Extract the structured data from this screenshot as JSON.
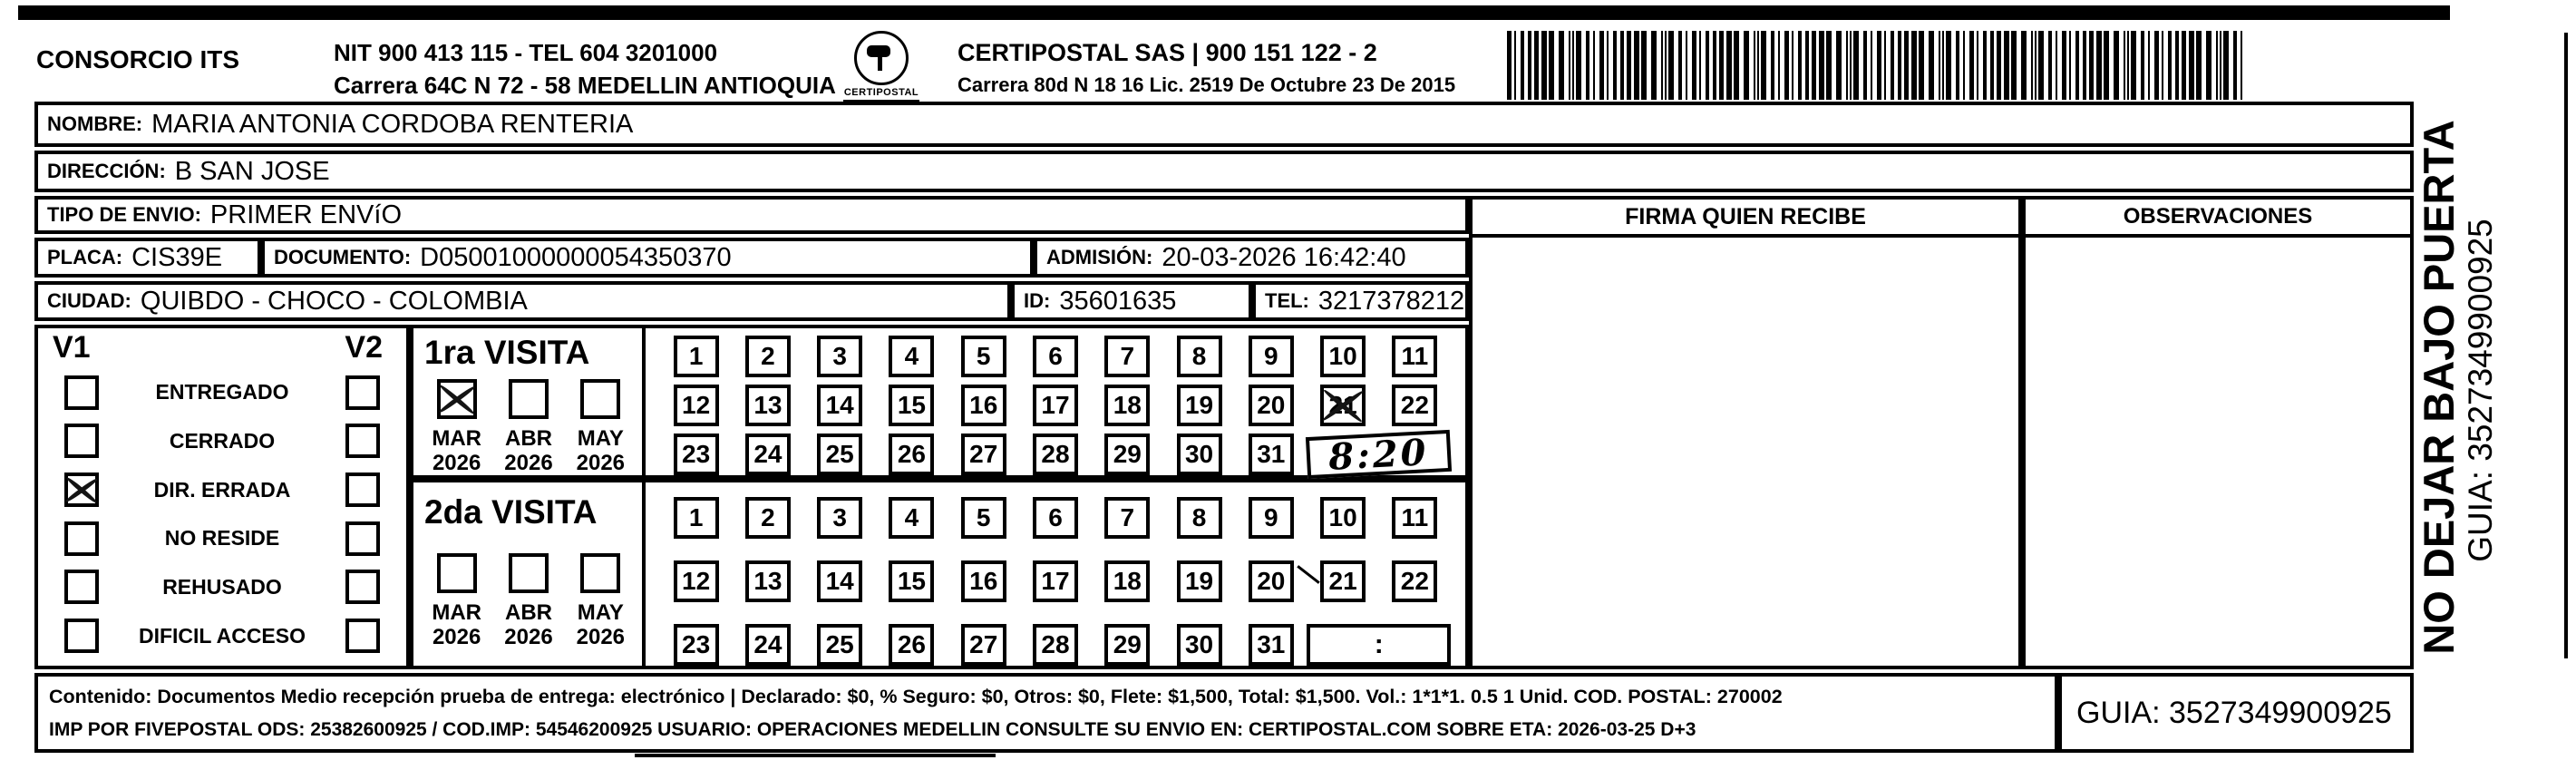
{
  "header": {
    "company": "CONSORCIO ITS",
    "nit_line1": "NIT 900 413 115 - TEL 604 3201000",
    "nit_line2": "Carrera 64C N 72 - 58 MEDELLIN ANTIOQUIA",
    "logo_text": "CERTIPOSTAL",
    "brand_line1": "CERTIPOSTAL SAS | 900 151 122 - 2",
    "brand_line2": "Carrera 80d N 18 16  Lic. 2519 De Octubre 23 De 2015"
  },
  "fields": {
    "nombre_label": "NOMBRE:",
    "nombre": "MARIA ANTONIA CORDOBA RENTERIA",
    "direccion_label": "DIRECCIÓN:",
    "direccion": "B SAN JOSE",
    "tipo_label": "TIPO DE ENVIO:",
    "tipo": "PRIMER ENVíO",
    "placa_label": "PLACA:",
    "placa": "CIS39E",
    "documento_label": "DOCUMENTO:",
    "documento": "D05001000000054350370",
    "admision_label": "ADMISIÓN:",
    "admision": "20-03-2026 16:42:40",
    "ciudad_label": "CIUDAD:",
    "ciudad": "QUIBDO - CHOCO - COLOMBIA",
    "id_label": "ID:",
    "id_value": "35601635",
    "tel_label": "TEL:",
    "tel": "3217378212"
  },
  "signature": {
    "firma_header": "FIRMA QUIEN RECIBE",
    "observaciones_header": "OBSERVACIONES"
  },
  "status": {
    "v1_label": "V1",
    "v2_label": "V2",
    "items": [
      {
        "label": "ENTREGADO",
        "v1": false,
        "v2": false
      },
      {
        "label": "CERRADO",
        "v1": false,
        "v2": false
      },
      {
        "label": "DIR. ERRADA",
        "v1": true,
        "v2": false
      },
      {
        "label": "NO RESIDE",
        "v1": false,
        "v2": false
      },
      {
        "label": "REHUSADO",
        "v1": false,
        "v2": false
      },
      {
        "label": "DIFICIL ACCESO",
        "v1": false,
        "v2": false
      }
    ]
  },
  "visits": [
    {
      "title": "1ra VISITA",
      "months": [
        {
          "month": "MAR",
          "year": "2026",
          "checked": true
        },
        {
          "month": "ABR",
          "year": "2026",
          "checked": false
        },
        {
          "month": "MAY",
          "year": "2026",
          "checked": false
        }
      ],
      "days": 31,
      "crossed_day": 21,
      "time": {
        "value": "8:20",
        "handwritten": true
      }
    },
    {
      "title": "2da VISITA",
      "months": [
        {
          "month": "MAR",
          "year": "2026",
          "checked": false
        },
        {
          "month": "ABR",
          "year": "2026",
          "checked": false
        },
        {
          "month": "MAY",
          "year": "2026",
          "checked": false
        }
      ],
      "days": 31,
      "crossed_day": null,
      "time": {
        "value": ":",
        "handwritten": false
      }
    }
  ],
  "footer": {
    "line1": "Contenido: Documentos Medio recepción prueba de entrega: electrónico | Declarado: $0, % Seguro: $0, Otros: $0, Flete: $1,500, Total: $1,500. Vol.: 1*1*1. 0.5  1 Unid. COD. POSTAL: 270002",
    "line2": "IMP POR FIVEPOSTAL ODS: 25382600925 / COD.IMP: 54546200925 USUARIO: OPERACIONES MEDELLIN CONSULTE SU ENVIO EN: CERTIPOSTAL.COM SOBRE ETA: 2026-03-25 D+3",
    "guia": "GUIA: 3527349900925"
  },
  "side": {
    "warning": "NO DEJAR BAJO PUERTA",
    "guia": "GUIA: 3527349900925"
  }
}
